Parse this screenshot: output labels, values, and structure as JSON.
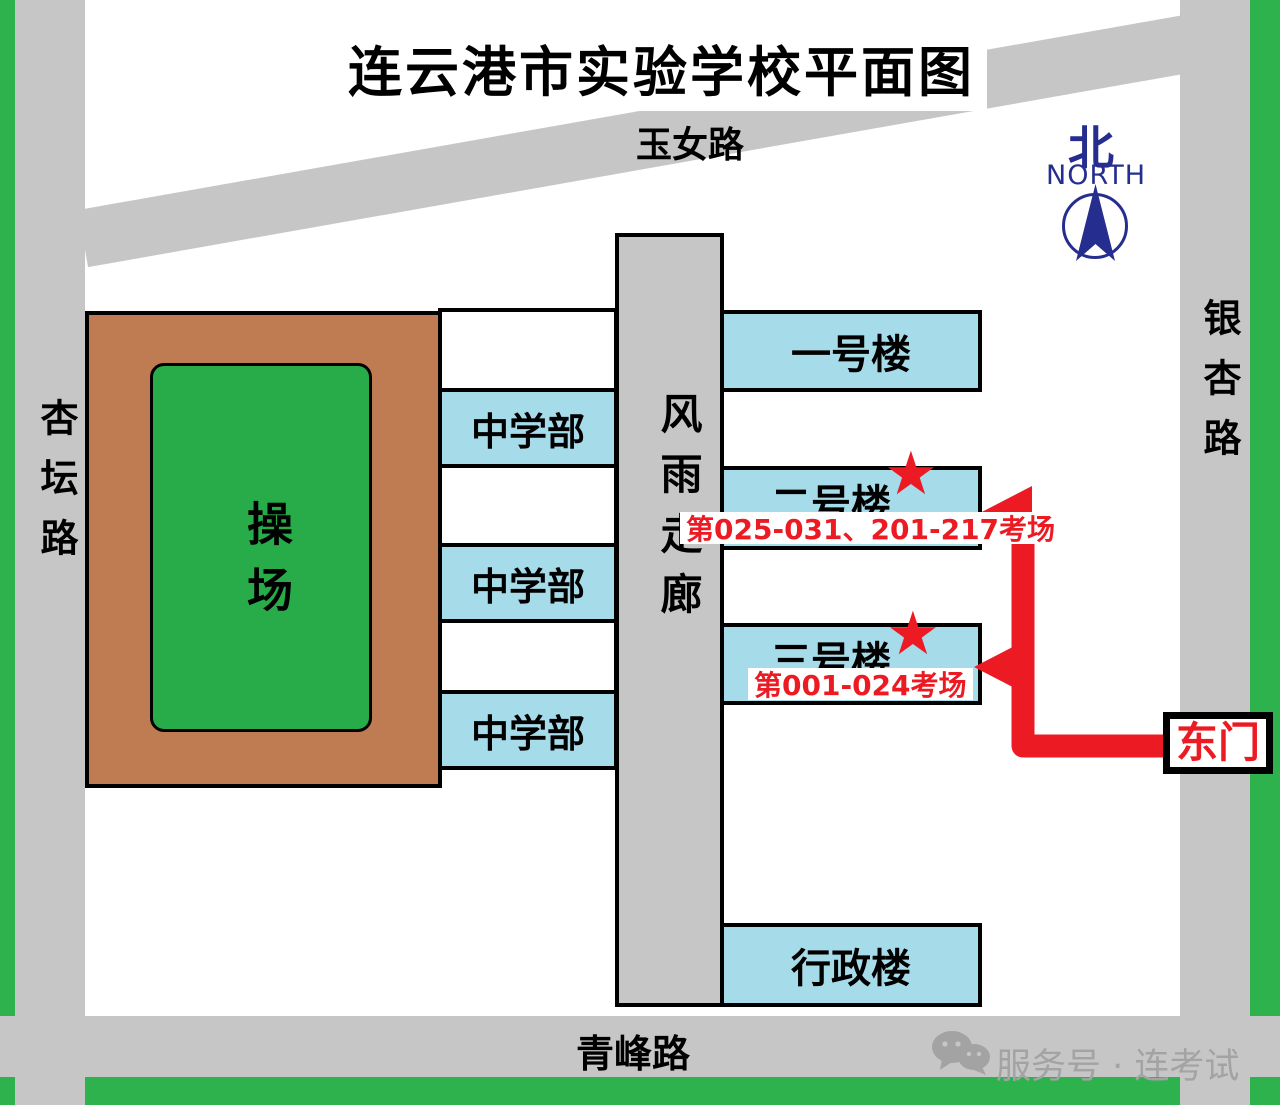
{
  "title": "连云港市实验学校平面图",
  "roads": {
    "top": "玉女路",
    "left": "杏坛路",
    "right": "银杏路",
    "bottom": "青峰路"
  },
  "compass": {
    "char": "北",
    "label": "NORTH"
  },
  "playground": {
    "label": "操场"
  },
  "corridor": {
    "label": "风雨走廊"
  },
  "buildings": {
    "middle_school": [
      "中学部",
      "中学部",
      "中学部"
    ],
    "building1": "一号楼",
    "building2": "二号楼",
    "building2_star": "★",
    "building2_note": "第025-031、201-217考场",
    "building3": "三号楼",
    "building3_star": "★",
    "building3_note": "第001-024考场",
    "admin": "行政楼"
  },
  "east_gate": {
    "label": "东门"
  },
  "watermark": {
    "text": "服务号 · 连考试"
  },
  "colors": {
    "building_blue": "#a6dbea",
    "road_gray": "#c6c6c6",
    "strip_green": "#2eb24d",
    "field_green": "#27ac49",
    "playground_brown": "#bf7b51",
    "accent_red": "#ec1b23",
    "compass_navy": "#252e8e",
    "watermark_gray": "#a3a3a3"
  }
}
